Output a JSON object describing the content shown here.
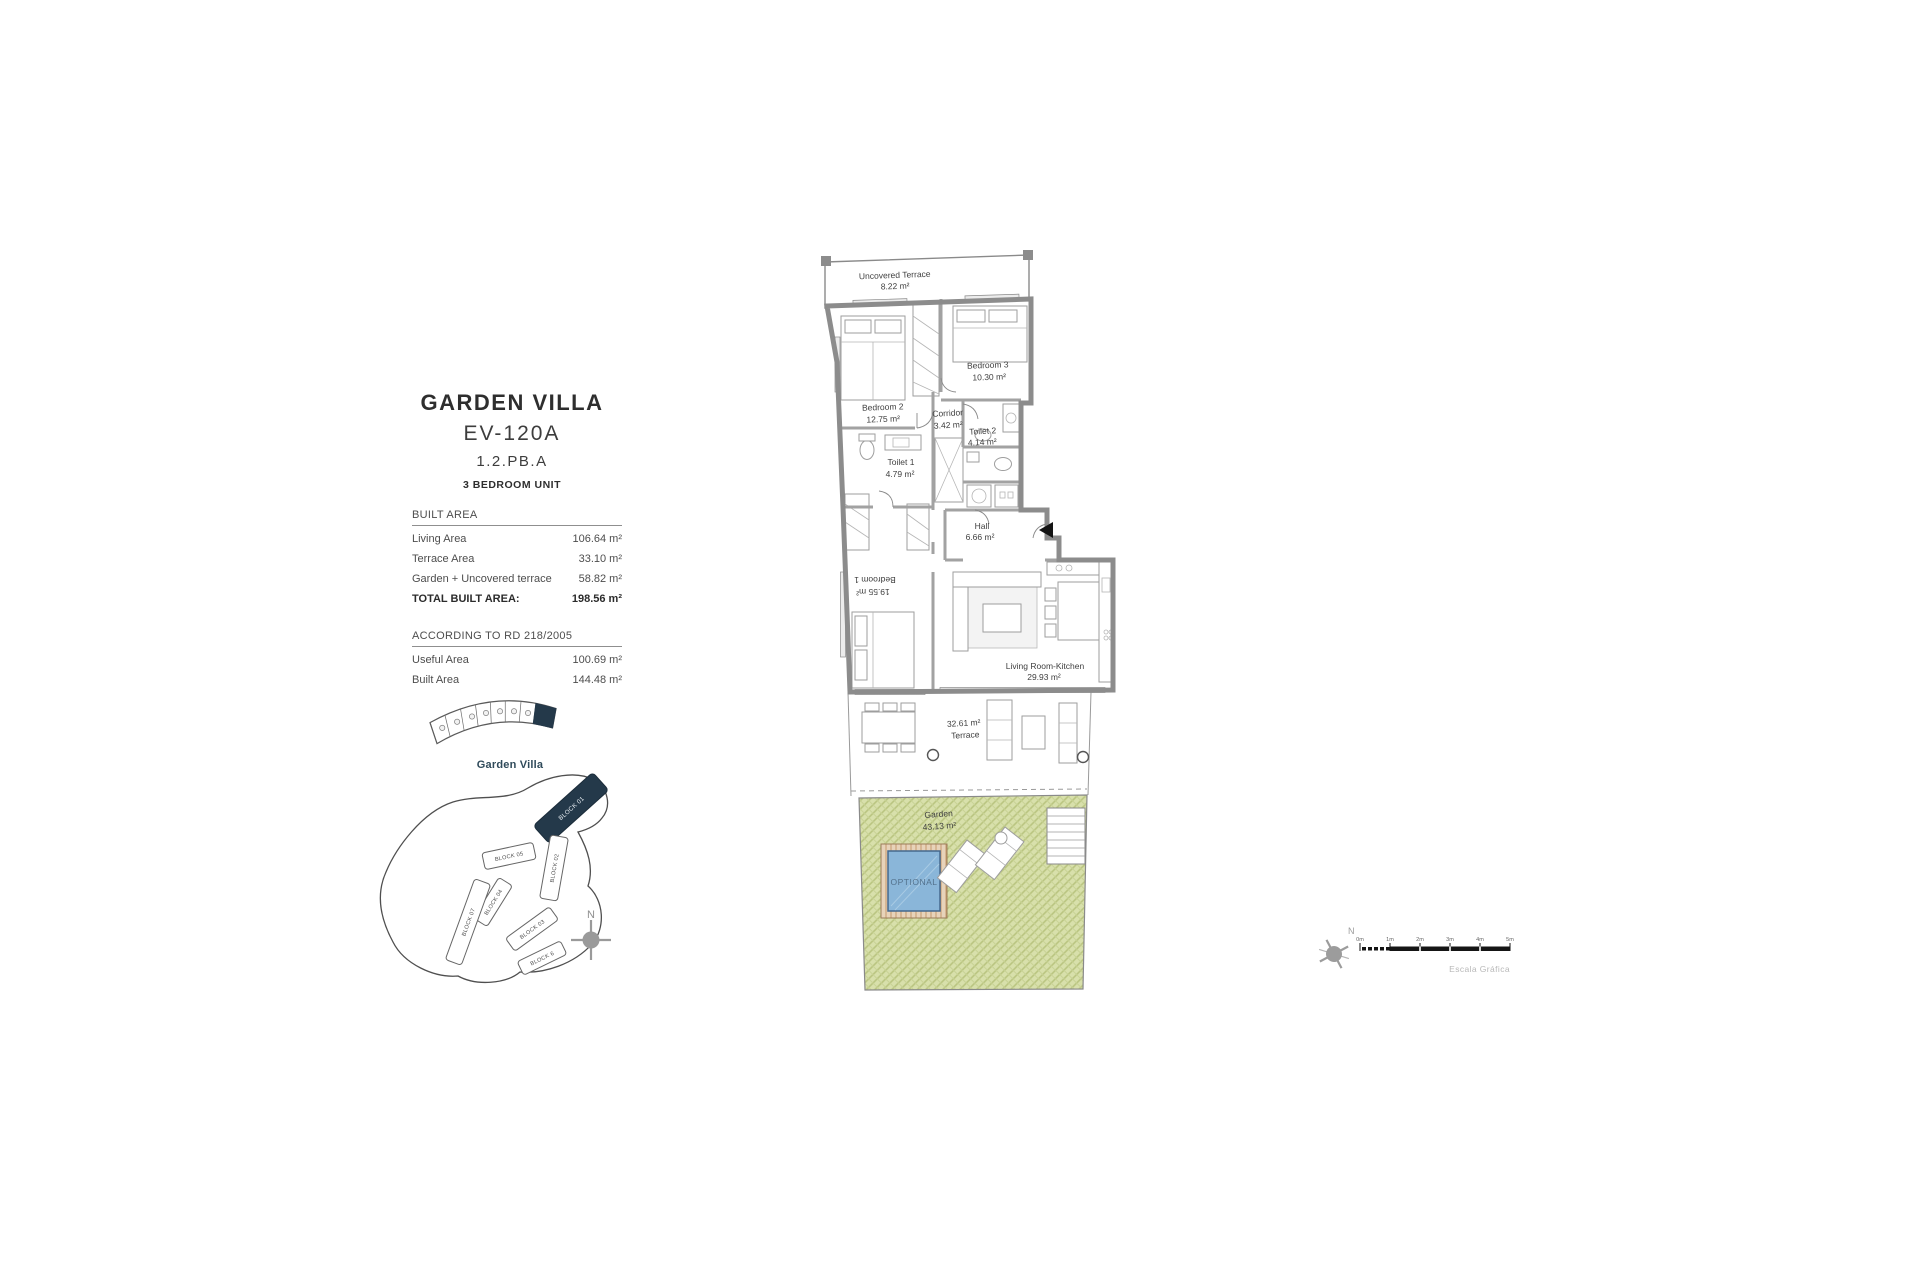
{
  "panel": {
    "title": "GARDEN VILLA",
    "code": "EV-120A",
    "ref": "1.2.PB.A",
    "unit_type": "3 BEDROOM UNIT",
    "built": {
      "header": "BUILT AREA",
      "rows": [
        {
          "label": "Living Area",
          "value": "106.64 m²"
        },
        {
          "label": "Terrace Area",
          "value": "33.10 m²"
        },
        {
          "label": "Garden + Uncovered terrace",
          "value": "58.82 m²"
        }
      ],
      "total_label": "TOTAL BUILT AREA:",
      "total_value": "198.56 m²"
    },
    "rd": {
      "header": "ACCORDING TO RD 218/2005",
      "rows": [
        {
          "label": "Useful Area",
          "value": "100.69 m²"
        },
        {
          "label": "Built Area",
          "value": "144.48 m²"
        }
      ]
    }
  },
  "keyplan": {
    "label": "Garden Villa"
  },
  "siteplan": {
    "blocks": [
      "BLOCK 01",
      "BLOCK 02",
      "BLOCK 05",
      "BLOCK 04",
      "BLOCK 07",
      "BLOCK 03",
      "BLOCK 6"
    ],
    "highlighted_block": "BLOCK 01",
    "north": "N"
  },
  "plan": {
    "rooms": [
      {
        "name": "Uncovered Terrace",
        "area": "8.22 m²"
      },
      {
        "name": "Bedroom 2",
        "area": "12.75 m²"
      },
      {
        "name": "Bedroom 3",
        "area": "10.30 m²"
      },
      {
        "name": "Corridor",
        "area": "3.42 m²"
      },
      {
        "name": "Toilet 2",
        "area": "4.14 m²"
      },
      {
        "name": "Toilet 1",
        "area": "4.79 m²"
      },
      {
        "name": "Hall",
        "area": "6.66 m²"
      },
      {
        "name": "Bedroom 1",
        "area": "19.55 m²"
      },
      {
        "name": "Living Room-Kitchen",
        "area": "29.93 m²"
      },
      {
        "name": "Terrace",
        "area": "32.61 m²"
      },
      {
        "name": "Garden",
        "area": "43.13 m²"
      }
    ],
    "pool_label": "OPTIONAL"
  },
  "scale": {
    "ticks": [
      "0m",
      "1m",
      "2m",
      "3m",
      "4m",
      "5m"
    ],
    "caption": "Escala Gráfica",
    "north": "N"
  },
  "colors": {
    "highlight_navy": "#24394a",
    "garden_green": "#d8e0ab",
    "pool_blue": "#8ab6d9",
    "deck_tan": "#e7d3ba"
  }
}
